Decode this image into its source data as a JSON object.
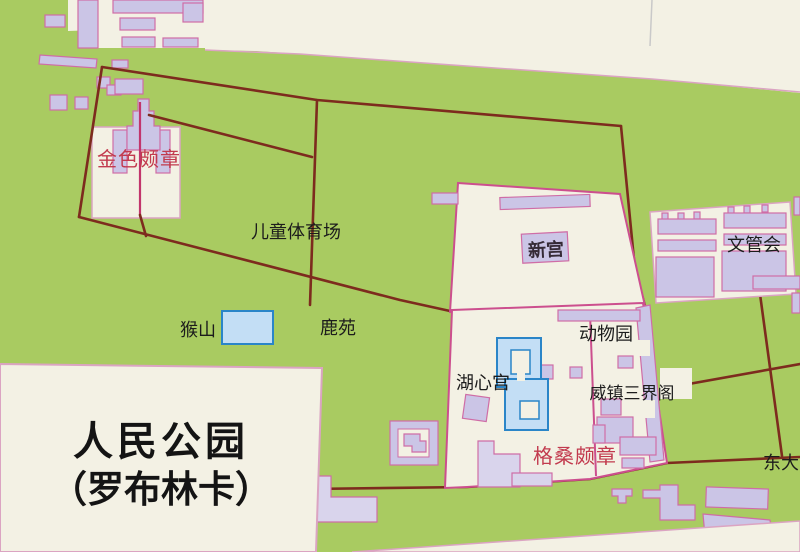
{
  "map": {
    "title_line1": "人民公园",
    "title_line2": "（罗布林卡）",
    "labels": {
      "jinse_pozhang": "金色颇章",
      "ertong_tiyuchang": "儿童体育场",
      "xingong": "新宫",
      "wenguanhui": "文管会",
      "houshan": "猴山",
      "luyuan": "鹿苑",
      "dongwuyuan": "动物园",
      "huxingong": "湖心宫",
      "weizhen_sanjiege": "威镇三界阁",
      "gesang_pozhang": "格桑颇章",
      "dongda": "东大"
    },
    "colors": {
      "park_green": "#a9cb61",
      "city_cream": "#f3f1e4",
      "building_lavender": "#cbc5e6",
      "building_outline_pink": "#cf6da6",
      "boundary_dark_red": "#7d2b1e",
      "enclosure_magenta": "#cc4f8e",
      "water_fill": "#c3def5",
      "water_border": "#2a85c8",
      "label_red": "#c23a4e",
      "label_black": "#1c1c1c"
    }
  }
}
